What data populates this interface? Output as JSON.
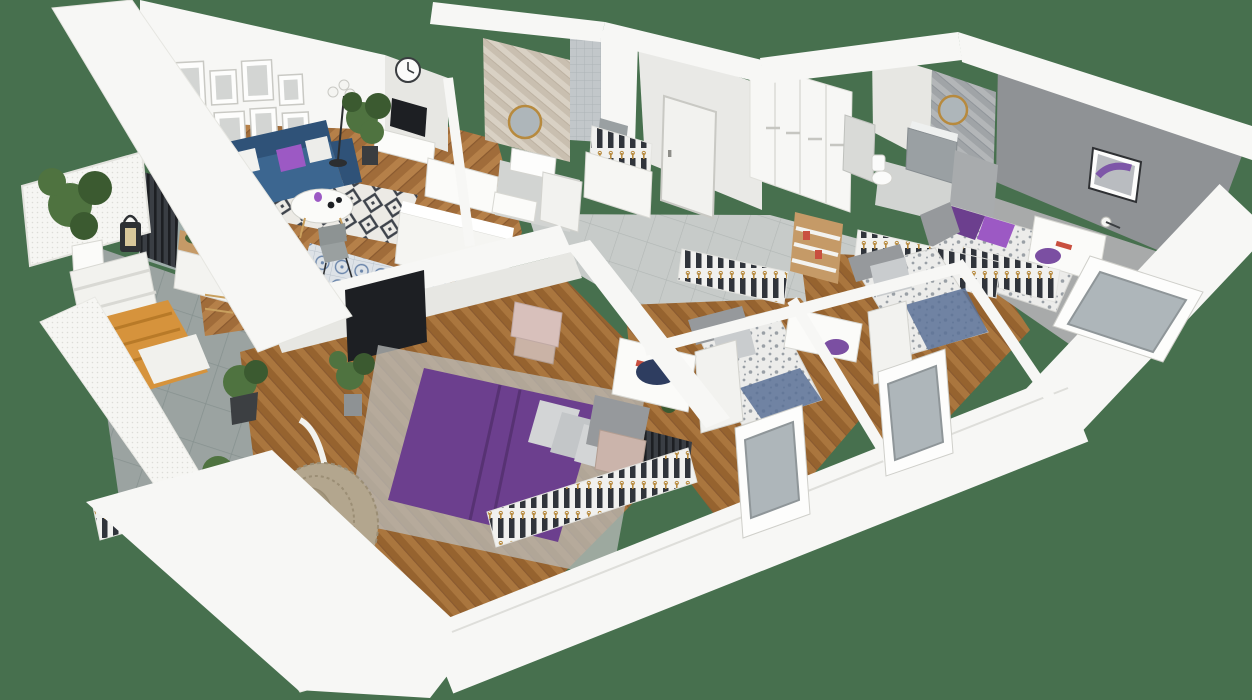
{
  "scene": {
    "title": "3d-apartment-floor-plan-render",
    "rooms": [
      {
        "id": "balcony",
        "items": [
          "potted-tree",
          "lantern",
          "lounge-chair",
          "wood-bench",
          "potted-plant",
          "hanging-egg-chair",
          "railing",
          "lattice-wall"
        ]
      },
      {
        "id": "living-room",
        "items": [
          "gallery-frames",
          "wall-clock",
          "blue-sofa",
          "purple-pillow",
          "coffee-table",
          "area-rug",
          "floor-lamp",
          "tall-plant",
          "tv",
          "tv-console",
          "shelving",
          "radiator"
        ]
      },
      {
        "id": "kitchen",
        "items": [
          "island-counter",
          "wood-counter",
          "coffee-machine",
          "patterned-tile-floor",
          "dining-chairs"
        ]
      },
      {
        "id": "bathroom-1",
        "items": [
          "herringbone-wall",
          "round-mirror",
          "sink-vanity",
          "shower",
          "open-door"
        ]
      },
      {
        "id": "hallway",
        "items": [
          "entrance-door",
          "coat-rack",
          "shoe-cabinet",
          "wardrobe",
          "tile-floor"
        ]
      },
      {
        "id": "master-bedroom",
        "items": [
          "double-bed-purple",
          "pillows",
          "nightstand",
          "rug",
          "wall-tv",
          "desk",
          "navy-pouf",
          "clothes-racks",
          "boxes",
          "plant"
        ]
      },
      {
        "id": "kids-bedroom-1",
        "items": [
          "single-bed",
          "gray-pillow",
          "desk",
          "purple-chair",
          "bookshelf-ladder",
          "clothes-rack",
          "window",
          "radiator"
        ]
      },
      {
        "id": "kids-bedroom-2",
        "items": [
          "single-bed",
          "gray-pillow",
          "desk",
          "clothes-rack",
          "window"
        ]
      },
      {
        "id": "bathroom-2",
        "items": [
          "gray-herringbone-wall",
          "round-mirror",
          "gray-vanity",
          "toilet",
          "appliance-tower"
        ]
      },
      {
        "id": "bedroom-3",
        "items": [
          "bed-purple-pillows",
          "gray-walls",
          "framed-art",
          "desk",
          "desk-lamp",
          "purple-chair",
          "clothes-rack",
          "window"
        ]
      }
    ]
  },
  "colors": {
    "bg": "#47704E",
    "wall": "#f7f7f5",
    "wallShade": "#e7e7e3",
    "wallDark": "#d4d4cf",
    "wood": "#a06c3a",
    "woodLight": "#b58049",
    "woodDark": "#8a5a30",
    "woodBed": "#96632f",
    "woodBedLight": "#aa763e",
    "tileBalcony": "#9ba3a1",
    "tileBalconyLine": "#879290",
    "tileHall": "#c7cbc9",
    "tileHallLine": "#b2b7b5",
    "sofaBlue": "#3c6690",
    "sofaBlueDark": "#2f5278",
    "purpleAccent": "#9c59c4",
    "purpleBed": "#6c3f8e",
    "purpleBedDark": "#573273",
    "purpleChair": "#7b4fa2",
    "rugBase": "#eceae5",
    "rugPattern": "#3e434b",
    "kitchenTileBase": "#dde2e7",
    "kitchenTileBlue": "#6b86ab",
    "herrBeige": "#d9d1c4",
    "herrBeigeAlt": "#c9bfb0",
    "herrGray": "#b3b6b8",
    "herrGrayAlt": "#a0a4a7",
    "showerTile": "#c2c7ca",
    "showerLine": "#aeb4b8",
    "grayWall": "#8f9295",
    "grayWallLight": "#a8abad",
    "bathFloor": "#d2d4d2",
    "floorGray": "#a8aaaa",
    "rackDark": "#30343b",
    "rackGold": "#b78a3e",
    "radiator": "#3a3e44",
    "plantGreen": "#4f7340",
    "plantGreenDark": "#3b5a30",
    "rattan": "#b3a68e",
    "rattanDark": "#9b8e75",
    "woodFurn": "#c59a67",
    "benchOrange": "#d6933c",
    "navy": "#2e3d60",
    "black": "#1d1f23",
    "glass": "#aeb6ba",
    "doorWhite": "#f2f2ef",
    "artPurple": "#7e57a8",
    "pink": "#d8c0bb",
    "duvet": "#ececea",
    "duvetDot": "#9aa0a6",
    "duvetBlue": "#5a7196",
    "headboard": "#96999c",
    "grayChair": "#9aa0a0"
  }
}
